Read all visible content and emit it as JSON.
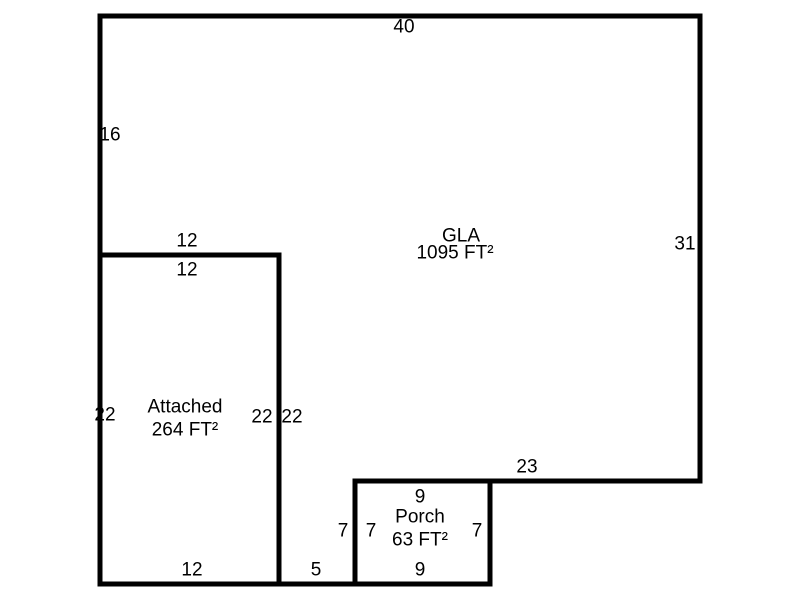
{
  "sketch": {
    "background": "#ffffff",
    "line_color": "#000000",
    "text_color": "#000000",
    "rooms": {
      "gla": {
        "name": "GLA",
        "area": "1095 FT²"
      },
      "attached": {
        "name": "Attached",
        "area": "264 FT²"
      },
      "porch": {
        "name": "Porch",
        "area": "63 FT²"
      }
    },
    "dims": {
      "top": "40",
      "left": "16",
      "right": "31",
      "gla_attached_top": "12",
      "attached_top": "12",
      "attached_left": "22",
      "attached_right": "22",
      "gla_lower_left": "22",
      "attached_bottom": "12",
      "gla_bottom": "23",
      "gla_strip_bottom": "5",
      "gla_porch_left": "7",
      "porch_left": "7",
      "porch_right": "7",
      "porch_top": "9",
      "porch_bottom": "9"
    }
  }
}
